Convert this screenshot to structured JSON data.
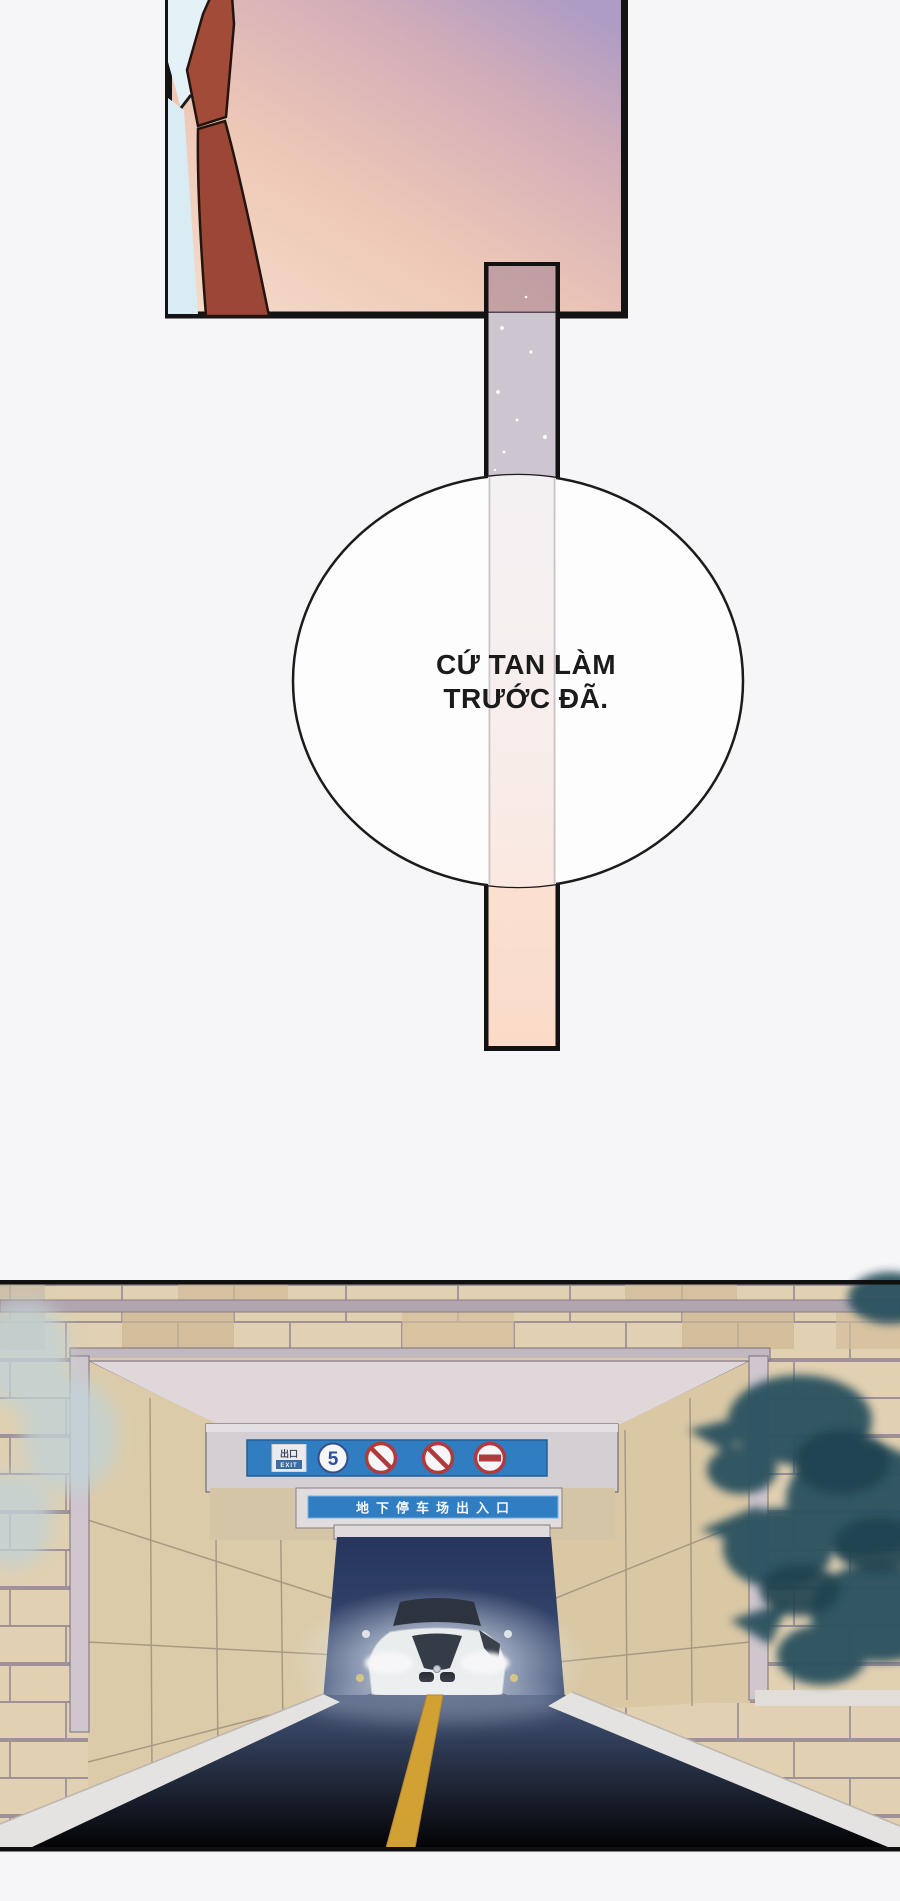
{
  "speech_bubble": {
    "line1": "CỨ TAN LÀM",
    "line2": "TRƯỚC ĐÃ."
  },
  "garage": {
    "sign_board": {
      "exit_label_cn": "出口",
      "exit_label_en": "EXIT",
      "speed_limit": "5",
      "icons": [
        "exit-sign",
        "speed-limit-5",
        "no-parking",
        "no-parking",
        "no-entry"
      ]
    },
    "entrance_sign": {
      "text": "地下停车场出入口"
    }
  },
  "colors": {
    "page_bg": "#f6f5f7",
    "panel_border": "#141414",
    "tie": "#9e4937",
    "collar": "#e4f1f7",
    "panel_gradient_top": "#ae9cc4",
    "panel_gradient_bottom": "#f6dcca",
    "sash_lavender": "#cdc5cf",
    "sash_peach": "#fbdfd0",
    "sign_blue": "#2f80c7",
    "prohibition_red": "#b53a3a",
    "tile_tan": "#e9d7b5",
    "tunnel_blue": "#273760",
    "road_blue": "#52688e",
    "lane_yellow": "#d8a631",
    "foliage_teal": "#2b535f",
    "car_white": "#f3f6f5"
  }
}
